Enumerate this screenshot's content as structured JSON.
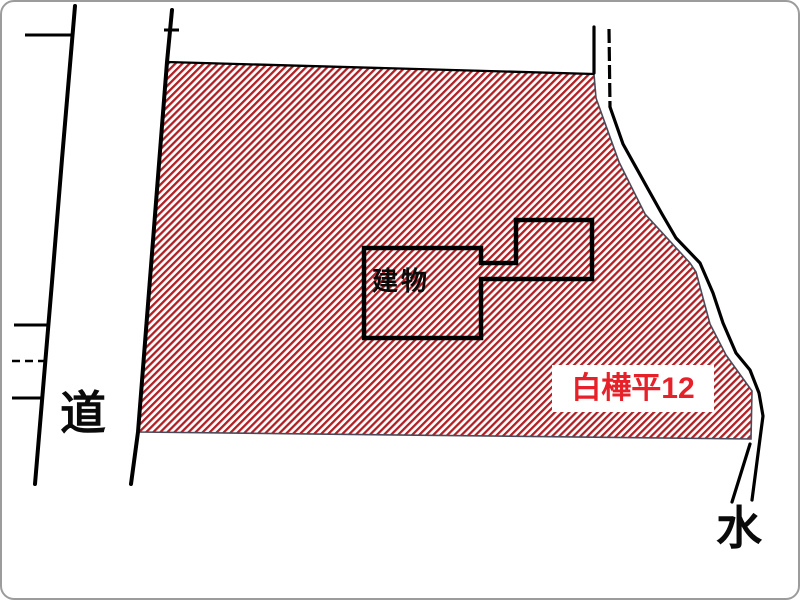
{
  "labels": {
    "road": "道",
    "water": "水",
    "building": "建物",
    "parcel_id": "白樺平12"
  },
  "colors": {
    "hatch_stripe": "#b01f24",
    "parcel_id_text": "#e62129",
    "parcel_outline": "#4a4a5a",
    "line_black": "#000000",
    "canvas_border": "#9c9c9c"
  },
  "map": {
    "parcel": {
      "name": "parcel-shirakabadaira-12",
      "points": [
        [
          165,
          60
        ],
        [
          592,
          72
        ],
        [
          594,
          96
        ],
        [
          617,
          160
        ],
        [
          643,
          212
        ],
        [
          688,
          261
        ],
        [
          694,
          270
        ],
        [
          708,
          322
        ],
        [
          724,
          353
        ],
        [
          750,
          389
        ],
        [
          749,
          437
        ],
        [
          136,
          430
        ]
      ]
    },
    "building": {
      "name": "building-footprint",
      "points": [
        [
          362,
          246
        ],
        [
          479,
          246
        ],
        [
          479,
          261
        ],
        [
          514,
          261
        ],
        [
          514,
          218
        ],
        [
          590,
          218
        ],
        [
          590,
          277
        ],
        [
          479,
          277
        ],
        [
          479,
          336
        ],
        [
          362,
          336
        ]
      ]
    },
    "lines": [
      {
        "name": "road-west-line",
        "kind": "road",
        "points": [
          [
            73,
            4
          ],
          [
            60,
            157
          ],
          [
            50,
            280
          ],
          [
            33,
            482
          ]
        ]
      },
      {
        "name": "road-west-branch-top",
        "kind": "stub",
        "points": [
          [
            23,
            33
          ],
          [
            71,
            33
          ]
        ]
      },
      {
        "name": "road-west-tick-1",
        "kind": "stub",
        "points": [
          [
            12,
            323
          ],
          [
            47,
            323
          ]
        ]
      },
      {
        "name": "road-west-tick-dashed",
        "kind": "stub-dashed",
        "points": [
          [
            10,
            359
          ],
          [
            46,
            359
          ]
        ]
      },
      {
        "name": "road-west-tick-2",
        "kind": "stub",
        "points": [
          [
            10,
            396
          ],
          [
            41,
            396
          ]
        ]
      },
      {
        "name": "road-east-line",
        "kind": "road",
        "points": [
          [
            170,
            8
          ],
          [
            165,
            60
          ],
          [
            136,
            430
          ],
          [
            129,
            482
          ]
        ]
      },
      {
        "name": "road-east-cross-tick",
        "kind": "tick",
        "points": [
          [
            162,
            28
          ],
          [
            177,
            28
          ]
        ]
      },
      {
        "name": "parcel-top-edge",
        "kind": "edge",
        "points": [
          [
            165,
            60
          ],
          [
            592,
            72
          ]
        ]
      },
      {
        "name": "water-channel-left-top",
        "kind": "channel",
        "points": [
          [
            592,
            25
          ],
          [
            592,
            71
          ]
        ]
      },
      {
        "name": "water-channel-right-top",
        "kind": "channel-dashed",
        "points": [
          [
            607,
            27
          ],
          [
            608,
            105
          ]
        ]
      },
      {
        "name": "water-channel-right-main",
        "kind": "channel",
        "points": [
          [
            608,
            105
          ],
          [
            621,
            142
          ],
          [
            646,
            187
          ],
          [
            660,
            212
          ],
          [
            674,
            236
          ],
          [
            698,
            261
          ],
          [
            711,
            291
          ],
          [
            721,
            321
          ],
          [
            734,
            351
          ],
          [
            748,
            368
          ],
          [
            757,
            391
          ],
          [
            761,
            414
          ],
          [
            759,
            429
          ],
          [
            750,
            498
          ]
        ]
      },
      {
        "name": "water-channel-lower-left",
        "kind": "channel",
        "points": [
          [
            748,
            442
          ],
          [
            730,
            500
          ]
        ]
      }
    ]
  }
}
